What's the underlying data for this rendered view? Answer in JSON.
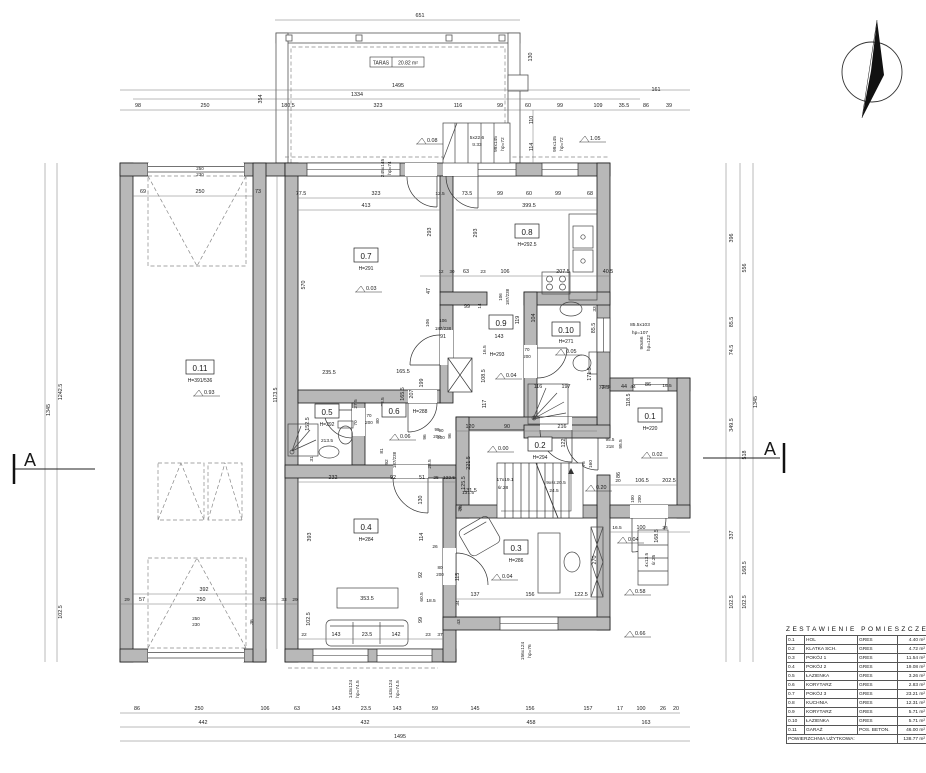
{
  "legend": {
    "title": "ZESTAWIENIE POMIESZCZEŃ",
    "rows": [
      [
        "0.1",
        "HOL",
        "GRES",
        "4.40 m²"
      ],
      [
        "0.2",
        "KLATKA SCH.",
        "GRES",
        "4.72 m²"
      ],
      [
        "0.3",
        "POKÓJ 1",
        "GRES",
        "11.54 m²"
      ],
      [
        "0.4",
        "POKÓJ 2",
        "GRES",
        "19.08 m²"
      ],
      [
        "0.5",
        "ŁAZIENKA",
        "GRES",
        "3.26 m²"
      ],
      [
        "0.6",
        "KORYTARZ",
        "GRES",
        "2.83 m²"
      ],
      [
        "0.7",
        "POKÓJ 3",
        "GRES",
        "23.21 m²"
      ],
      [
        "0.8",
        "KUCHNIA",
        "GRES",
        "12.31 m²"
      ],
      [
        "0.9",
        "KORYTARZ",
        "GRES",
        "5.71 m²"
      ],
      [
        "0.10",
        "ŁAZIENKA",
        "GRES",
        "5.71 m²"
      ],
      [
        "0.11",
        "GARAŻ",
        "POS. BETON.",
        "46.00 m²"
      ]
    ],
    "total_label": "POWIERZCHNIA UŻYTKOWA:",
    "total_area": "138.77 m²"
  },
  "plan": {
    "taras": {
      "label": "TARAS",
      "area": "20.82 m²"
    },
    "section": {
      "label": "A"
    },
    "colors": {
      "wall": "#b8b8b8",
      "line": "#1a1a1a",
      "dim": "#555555"
    },
    "rooms": [
      {
        "id": "0.11",
        "x": 200,
        "y": 368,
        "h": "H=391/536",
        "hx": 200,
        "hy": 382
      },
      {
        "id": "0.7",
        "x": 366,
        "y": 256,
        "h": "H=291",
        "hx": 366,
        "hy": 270
      },
      {
        "id": "0.8",
        "x": 527,
        "y": 232,
        "h": "H=292.5",
        "hx": 527,
        "hy": 246
      },
      {
        "id": "0.9",
        "x": 501,
        "y": 323,
        "h": "H=293",
        "hx": 497,
        "hy": 356
      },
      {
        "id": "0.10",
        "x": 566,
        "y": 330,
        "h": "H=271",
        "hx": 566,
        "hy": 343
      },
      {
        "id": "0.5",
        "x": 327,
        "y": 412,
        "h": "H=292",
        "hx": 327,
        "hy": 426
      },
      {
        "id": "0.6",
        "x": 394,
        "y": 411,
        "h": "H=288",
        "hx": 420,
        "hy": 413
      },
      {
        "id": "0.2",
        "x": 540,
        "y": 445,
        "h": "H=294",
        "hx": 540,
        "hy": 459
      },
      {
        "id": "0.1",
        "x": 650,
        "y": 416,
        "h": "H=220",
        "hx": 650,
        "hy": 430
      },
      {
        "id": "0.4",
        "x": 366,
        "y": 527,
        "h": "H=284",
        "hx": 366,
        "hy": 541
      },
      {
        "id": "0.3",
        "x": 516,
        "y": 548,
        "h": "H=286",
        "hx": 516,
        "hy": 562
      }
    ],
    "levels": [
      [
        366,
        290,
        "0.03"
      ],
      [
        427,
        142,
        "0.08"
      ],
      [
        590,
        140,
        "1.05"
      ],
      [
        204,
        394,
        "0.93"
      ],
      [
        506,
        377,
        "0.04"
      ],
      [
        566,
        353,
        "0.05"
      ],
      [
        400,
        438,
        "0.06"
      ],
      [
        498,
        450,
        "0.00"
      ],
      [
        652,
        456,
        "0.02"
      ],
      [
        596,
        489,
        "0.20"
      ],
      [
        502,
        578,
        "0.04"
      ],
      [
        628,
        541,
        "0.04"
      ],
      [
        635,
        593,
        "0.58"
      ],
      [
        635,
        635,
        "0.66"
      ]
    ],
    "dim_labels": [
      [
        420,
        17,
        "651"
      ],
      [
        398,
        87,
        "1495"
      ],
      [
        357,
        96,
        "1334"
      ],
      [
        138,
        107,
        "98"
      ],
      [
        205,
        107,
        "250"
      ],
      [
        262,
        99,
        "354",
        -90
      ],
      [
        288,
        107,
        "180.5"
      ],
      [
        378,
        107,
        "323"
      ],
      [
        458,
        107,
        "116"
      ],
      [
        500,
        107,
        "99"
      ],
      [
        528,
        107,
        "60"
      ],
      [
        560,
        107,
        "99"
      ],
      [
        598,
        107,
        "109"
      ],
      [
        624,
        107,
        "35.5"
      ],
      [
        646,
        107,
        "86"
      ],
      [
        669,
        107,
        "39"
      ],
      [
        656,
        91,
        "161"
      ],
      [
        532,
        57,
        "130",
        -90
      ],
      [
        533,
        120,
        "110",
        -90
      ],
      [
        533,
        147,
        "114",
        -90
      ],
      [
        384,
        168,
        "245x145",
        -90,
        4.8
      ],
      [
        391,
        168,
        "hp=74",
        -90,
        4.8
      ],
      [
        477,
        139,
        "5x22.6",
        0,
        4.8
      ],
      [
        477,
        146,
        "tr.33",
        0,
        4.8
      ],
      [
        497,
        144,
        "99x145",
        -90,
        4.8
      ],
      [
        504,
        144,
        "hp=72",
        -90,
        4.8
      ],
      [
        556,
        144,
        "99x145",
        -90,
        4.8
      ],
      [
        563,
        144,
        "hp=72",
        -90,
        4.8
      ],
      [
        50,
        410,
        "1345",
        -90
      ],
      [
        62,
        392,
        "1242.5",
        -90
      ],
      [
        62,
        612,
        "102.5",
        -90
      ],
      [
        277,
        395,
        "1173.5",
        -90,
        5
      ],
      [
        733,
        238,
        "396",
        -90
      ],
      [
        746,
        268,
        "556",
        -90
      ],
      [
        733,
        322,
        "85.5",
        -90
      ],
      [
        733,
        350,
        "74.5",
        -90
      ],
      [
        733,
        425,
        "349.5",
        -90
      ],
      [
        746,
        455,
        "518",
        -90
      ],
      [
        757,
        402,
        "1345",
        -90
      ],
      [
        733,
        535,
        "337",
        -90
      ],
      [
        746,
        568,
        "168.5",
        -90
      ],
      [
        733,
        602,
        "102.5",
        -90
      ],
      [
        746,
        602,
        "102.5",
        -90
      ],
      [
        137,
        710,
        "86"
      ],
      [
        199,
        710,
        "250"
      ],
      [
        265,
        710,
        "106"
      ],
      [
        297,
        710,
        "63"
      ],
      [
        336,
        710,
        "143"
      ],
      [
        366,
        710,
        "23.5"
      ],
      [
        397,
        710,
        "143"
      ],
      [
        435,
        710,
        "59"
      ],
      [
        475,
        710,
        "145"
      ],
      [
        530,
        710,
        "156"
      ],
      [
        588,
        710,
        "157"
      ],
      [
        620,
        710,
        "17"
      ],
      [
        641,
        710,
        "100"
      ],
      [
        663,
        710,
        "26"
      ],
      [
        676,
        710,
        "20"
      ],
      [
        203,
        724,
        "442"
      ],
      [
        365,
        724,
        "432"
      ],
      [
        531,
        724,
        "458"
      ],
      [
        646,
        724,
        "163"
      ],
      [
        400,
        738,
        "1495"
      ],
      [
        200,
        170,
        "250",
        0,
        4.5
      ],
      [
        200,
        176,
        "230",
        0,
        4.5
      ],
      [
        143,
        193,
        "69"
      ],
      [
        200,
        193,
        "250"
      ],
      [
        258,
        193,
        "73"
      ],
      [
        204,
        591,
        "392"
      ],
      [
        127,
        601,
        "29",
        0,
        4.8
      ],
      [
        142,
        601,
        "57"
      ],
      [
        201,
        601,
        "250"
      ],
      [
        263,
        601,
        "85"
      ],
      [
        284,
        601,
        "33",
        0,
        4.8
      ],
      [
        295,
        601,
        "29",
        0,
        4.8
      ],
      [
        196,
        620,
        "250",
        0,
        4.5
      ],
      [
        196,
        626,
        "230",
        0,
        4.5
      ],
      [
        253,
        622,
        "36",
        -90,
        4.8
      ],
      [
        301,
        195,
        "77.5"
      ],
      [
        376,
        195,
        "323"
      ],
      [
        366,
        207,
        "413"
      ],
      [
        440,
        195,
        "12.5",
        0,
        4.8
      ],
      [
        305,
        285,
        "570",
        -90
      ],
      [
        431,
        232,
        "293",
        -90
      ],
      [
        477,
        233,
        "293",
        -90
      ],
      [
        430,
        291,
        "47",
        -90
      ],
      [
        429,
        323,
        "106",
        -90,
        4.8
      ],
      [
        443,
        322,
        "106",
        0,
        4.5
      ],
      [
        443,
        330,
        "187/238",
        0,
        4.5
      ],
      [
        441,
        273,
        "12",
        0,
        4.5
      ],
      [
        452,
        273,
        "30",
        0,
        4.5
      ],
      [
        466,
        273,
        "63"
      ],
      [
        483,
        273,
        "23",
        0,
        4.8
      ],
      [
        505,
        273,
        "106"
      ],
      [
        563,
        273,
        "207.5"
      ],
      [
        608,
        273,
        "40.5"
      ],
      [
        329,
        374,
        "235.5"
      ],
      [
        403,
        373,
        "165.5"
      ],
      [
        467,
        195,
        "73.5"
      ],
      [
        500,
        195,
        "99"
      ],
      [
        529,
        195,
        "60"
      ],
      [
        558,
        195,
        "99"
      ],
      [
        590,
        195,
        "68"
      ],
      [
        529,
        207,
        "399.5"
      ],
      [
        502,
        297,
        "106",
        -90,
        4.5
      ],
      [
        509,
        297,
        "187/238",
        -90,
        4.5
      ],
      [
        519,
        320,
        "119",
        -90
      ],
      [
        535,
        318,
        "104",
        -90
      ],
      [
        467,
        308,
        "99"
      ],
      [
        481,
        306,
        "14",
        -90,
        4.8
      ],
      [
        499,
        338,
        "143"
      ],
      [
        443,
        338,
        "91"
      ],
      [
        486,
        350,
        "16.5",
        -90,
        4.8
      ],
      [
        485,
        376,
        "108.5",
        -90
      ],
      [
        486,
        404,
        "117",
        -90
      ],
      [
        527,
        351,
        "70",
        0,
        4.5
      ],
      [
        527,
        358,
        "200",
        0,
        4.5
      ],
      [
        596,
        309,
        "33",
        -90,
        4.8
      ],
      [
        595,
        328,
        "85.5",
        -90
      ],
      [
        591,
        374,
        "171.5",
        -90
      ],
      [
        538,
        388,
        "116"
      ],
      [
        566,
        388,
        "197"
      ],
      [
        604,
        389,
        "72.5"
      ],
      [
        624,
        388,
        "44"
      ],
      [
        630,
        400,
        "118.5",
        -90
      ],
      [
        643,
        343,
        "90x66",
        -90,
        4.8
      ],
      [
        650,
        343,
        "hp=122",
        -90,
        4.8
      ],
      [
        640,
        326,
        "85.5x103",
        0,
        4.8
      ],
      [
        640,
        334,
        "hp=107",
        0,
        4.8
      ],
      [
        606,
        388,
        "32.5",
        0,
        4.8
      ],
      [
        633,
        388,
        "44",
        0,
        4.8
      ],
      [
        648,
        386,
        "86"
      ],
      [
        667,
        387,
        "16.5",
        0,
        4.8
      ],
      [
        610,
        441,
        "95.5",
        0,
        4.5
      ],
      [
        610,
        448,
        "218",
        0,
        4.5
      ],
      [
        622,
        444,
        "95.5",
        -90,
        4.8
      ],
      [
        620,
        475,
        "86",
        -90
      ],
      [
        618,
        482,
        "20",
        0,
        4.8
      ],
      [
        642,
        482,
        "106.5"
      ],
      [
        669,
        482,
        "202.5"
      ],
      [
        634,
        499,
        "100",
        -90,
        4.5
      ],
      [
        641,
        499,
        "200",
        -90,
        4.5
      ],
      [
        617,
        529,
        "16.5",
        0,
        4.8
      ],
      [
        641,
        529,
        "100"
      ],
      [
        665,
        529,
        "26",
        0,
        4.8
      ],
      [
        648,
        560,
        "4x13.5",
        -90,
        4.8
      ],
      [
        655,
        560,
        "śr.25",
        -90,
        4.8
      ],
      [
        470,
        428,
        "120"
      ],
      [
        507,
        428,
        "90"
      ],
      [
        562,
        428,
        "216"
      ],
      [
        565,
        443,
        "122",
        -90
      ],
      [
        451,
        436,
        "96",
        -90,
        4.8
      ],
      [
        437,
        431,
        "98",
        0,
        4.5
      ],
      [
        437,
        438,
        "200",
        0,
        4.5
      ],
      [
        470,
        463,
        "221.5",
        -90
      ],
      [
        465,
        483,
        "125.5",
        -90
      ],
      [
        470,
        492,
        "131.5"
      ],
      [
        462,
        508,
        "26",
        -90,
        4.8
      ],
      [
        505,
        481,
        "17x19.1",
        0,
        4.8
      ],
      [
        503,
        489,
        "śr.28",
        0,
        4.8
      ],
      [
        556,
        484,
        "9xśr.20.5",
        0,
        4.8
      ],
      [
        554,
        492,
        "24.5",
        0,
        4.8
      ],
      [
        585,
        464,
        "75",
        -90,
        4.8
      ],
      [
        592,
        464,
        "160",
        -90,
        4.8
      ],
      [
        357,
        404,
        "27.5",
        -90,
        4.8
      ],
      [
        384,
        402,
        "38.5",
        -90,
        4.8
      ],
      [
        404,
        394,
        "165.5",
        -90
      ],
      [
        413,
        394,
        "207",
        -90
      ],
      [
        423,
        383,
        "199",
        -90
      ],
      [
        309,
        424,
        "152.5",
        -90
      ],
      [
        327,
        442,
        "213.5",
        0,
        4.8
      ],
      [
        313,
        459,
        "31",
        -90,
        4.8
      ],
      [
        357,
        423,
        "70",
        -90,
        4.8
      ],
      [
        369,
        417,
        "70",
        0,
        4.5
      ],
      [
        369,
        424,
        "200",
        0,
        4.5
      ],
      [
        379,
        421,
        "80",
        -90,
        4.8
      ],
      [
        426,
        437,
        "96",
        -90,
        4.8
      ],
      [
        441,
        432,
        "90",
        0,
        4.5
      ],
      [
        441,
        439,
        "200",
        0,
        4.5
      ],
      [
        383,
        451,
        "81",
        -90,
        4.8
      ],
      [
        388,
        462,
        "92",
        -90,
        4.8
      ],
      [
        396,
        460,
        "187/238",
        -90,
        4.5
      ],
      [
        431,
        464,
        "28.5",
        -90,
        4.8
      ],
      [
        333,
        479,
        "232"
      ],
      [
        393,
        479,
        "92"
      ],
      [
        422,
        479,
        "51"
      ],
      [
        436,
        479,
        "25",
        0,
        4.8
      ],
      [
        449,
        479,
        "122.5",
        0,
        4.8
      ],
      [
        311,
        537,
        "393",
        -90
      ],
      [
        422,
        500,
        "130",
        -90
      ],
      [
        423,
        537,
        "114",
        -90
      ],
      [
        435,
        548,
        "26",
        0,
        4.8
      ],
      [
        422,
        575,
        "92",
        -90
      ],
      [
        440,
        569,
        "80",
        0,
        4.5
      ],
      [
        440,
        576,
        "200",
        0,
        4.5
      ],
      [
        459,
        577,
        "115",
        -90
      ],
      [
        423,
        597,
        "60.5",
        -90,
        4.8
      ],
      [
        431,
        602,
        "18.5",
        0,
        4.8
      ],
      [
        422,
        620,
        "99",
        -90
      ],
      [
        310,
        619,
        "102.5",
        -90
      ],
      [
        367,
        600,
        "353.5"
      ],
      [
        304,
        636,
        "22",
        0,
        4.8
      ],
      [
        336,
        636,
        "143"
      ],
      [
        367,
        636,
        "23.5"
      ],
      [
        396,
        636,
        "142"
      ],
      [
        428,
        636,
        "23",
        0,
        4.8
      ],
      [
        440,
        636,
        "37",
        0,
        4.8
      ],
      [
        352,
        689,
        "143x124",
        -90,
        4.8
      ],
      [
        359,
        689,
        "hp=74.5",
        -90,
        4.8
      ],
      [
        392,
        689,
        "143x124",
        -90,
        4.8
      ],
      [
        399,
        689,
        "hp=74.5",
        -90,
        4.8
      ],
      [
        468,
        494,
        "131.5",
        0,
        4.8
      ],
      [
        461,
        509,
        "26",
        -90,
        4.8
      ],
      [
        475,
        596,
        "137"
      ],
      [
        530,
        596,
        "156"
      ],
      [
        581,
        596,
        "122.5"
      ],
      [
        596,
        560,
        "270",
        -90
      ],
      [
        459,
        603,
        "34",
        -90,
        4.8
      ],
      [
        460,
        622,
        "43",
        -90,
        4.8
      ],
      [
        658,
        536,
        "168.5",
        -90
      ],
      [
        524,
        651,
        "156x124",
        -90,
        4.8
      ],
      [
        531,
        651,
        "hp=76",
        -90,
        4.8
      ]
    ]
  }
}
